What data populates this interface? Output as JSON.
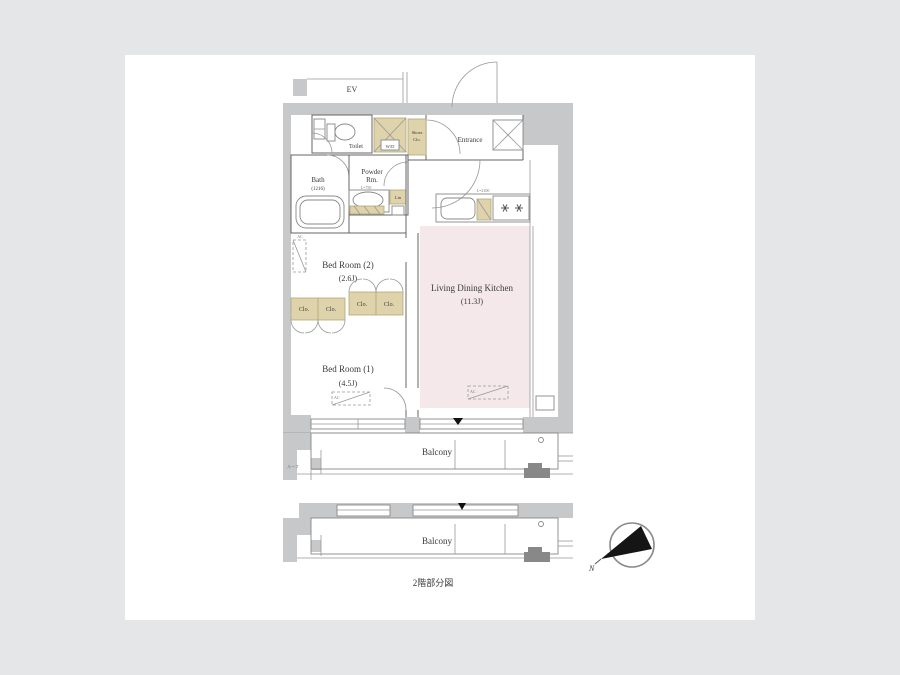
{
  "title": "apartment-floor-plan",
  "colors": {
    "background": "#e5e6e8",
    "card": "#ffffff",
    "wall_gray": "#c6c8ca",
    "closet_tan": "#dfd3ab",
    "ldk_pink": "#f5e8ea",
    "line": "#666666",
    "text": "#3a3a3a"
  },
  "labels": {
    "ev": "EV",
    "toilet": "Toilet",
    "bath": "Bath",
    "bath_size": "(1216)",
    "powder_line1": "Powder",
    "powder_line2": "Rm.",
    "linen": "Lin",
    "washer": "W/D",
    "shoes_line1": "Shoes",
    "shoes_line2": "Clo.",
    "entrance": "Entrance",
    "kitchen_dim": "L=2100",
    "vanity_dim": "L=750",
    "ldk_line1": "Living Dining Kitchen",
    "ldk_line2": "(11.3J)",
    "bed2_line1": "Bed Room (2)",
    "bed2_line2": "(2.6J)",
    "bed1_line1": "Bed Room (1)",
    "bed1_line2": "(4.5J)",
    "closet": "Clo.",
    "ac": "AC",
    "balcony_upper": "Balcony",
    "balcony_lower": "Balcony",
    "roof_note": "ルーフ",
    "floor_note": "2階部分図",
    "north": "N"
  }
}
